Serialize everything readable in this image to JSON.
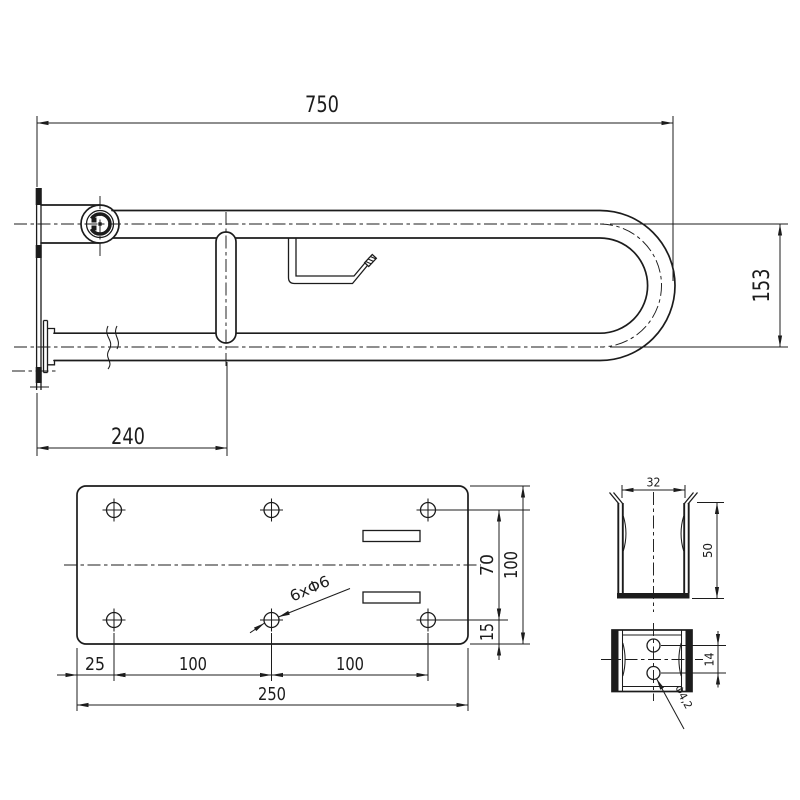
{
  "drawing": {
    "background": "#ffffff",
    "line_color": "#1c1c1c",
    "side_view": {
      "dim_length": "750",
      "dim_height": "153",
      "dim_pivot_offset": "240"
    },
    "plate_view": {
      "dim_edge_to_hole": "25",
      "dim_hole_span_left": "100",
      "dim_hole_span_right": "100",
      "dim_total_width": "250",
      "dim_hole_rows": "70",
      "dim_total_height": "100",
      "dim_bottom_margin": "15",
      "holes_label": "6xΦ6"
    },
    "clamp_side_view": {
      "dim_width": "32",
      "dim_height": "50"
    },
    "clamp_front_view": {
      "dim_hole_spacing": "14",
      "hole_dia_label": "Φ4,2"
    }
  }
}
